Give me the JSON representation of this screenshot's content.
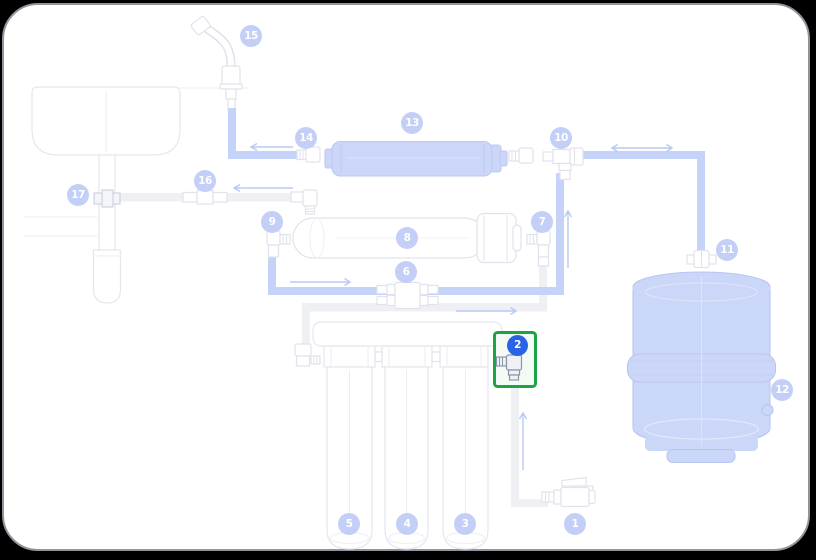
{
  "diagram": {
    "parts": [
      {
        "label": "1"
      },
      {
        "label": "2"
      },
      {
        "label": "3"
      },
      {
        "label": "4"
      },
      {
        "label": "5"
      },
      {
        "label": "6"
      },
      {
        "label": "7"
      },
      {
        "label": "8"
      },
      {
        "label": "9"
      },
      {
        "label": "10"
      },
      {
        "label": "11"
      },
      {
        "label": "12"
      },
      {
        "label": "13"
      },
      {
        "label": "14"
      },
      {
        "label": "15"
      },
      {
        "label": "16"
      },
      {
        "label": "17"
      }
    ],
    "highlighted_part": "2",
    "colors": {
      "component_blue": "#cbd6f8",
      "tube_blue": "#c6d3f8",
      "tube_gray": "#eef0f4",
      "badge_blue": "#c3cff6",
      "selected_badge_blue": "#2b63e6",
      "highlight_green": "#1ba441",
      "outline_gray": "#dfe3ec"
    }
  }
}
